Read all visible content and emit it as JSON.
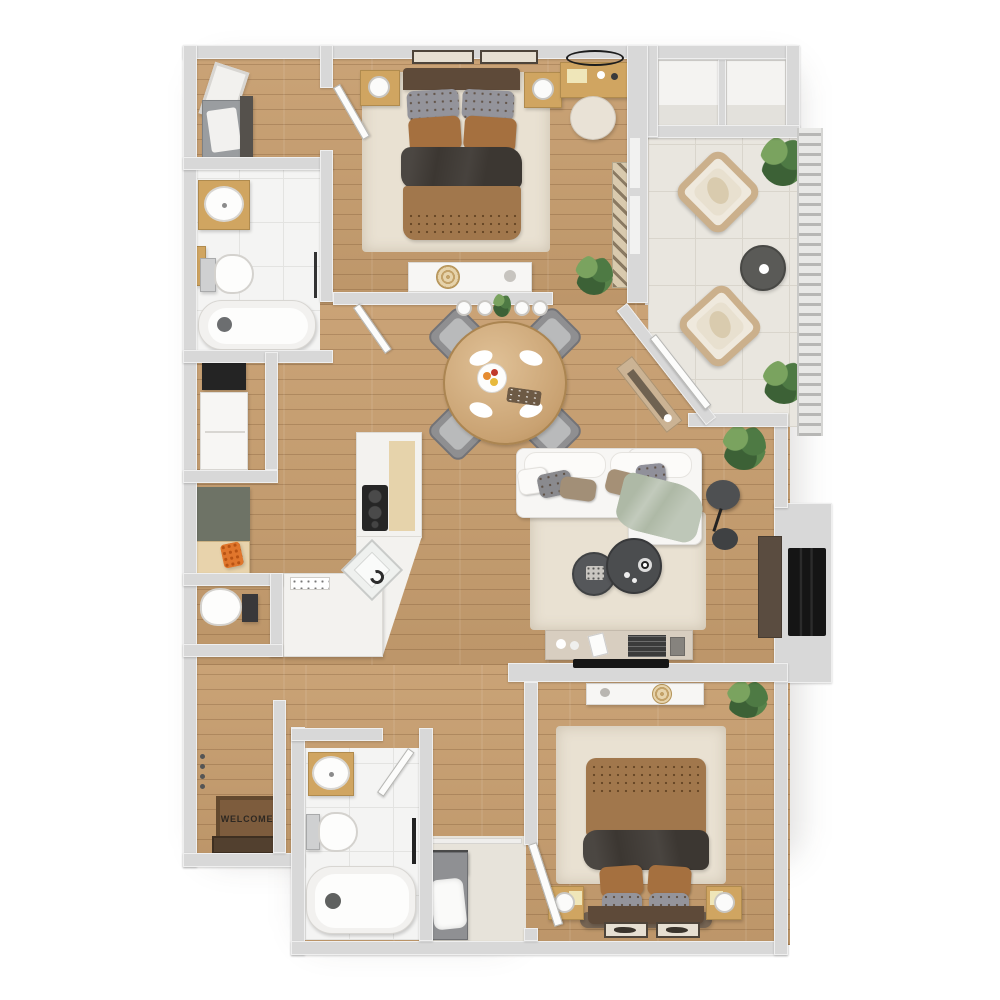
{
  "labels": {
    "welcome_mat": "WELCOME"
  },
  "palette": {
    "wall": "#d8d8d8",
    "wood": "#c79e6f",
    "tile": "#f4f4f3",
    "grout": "#e3e3e1",
    "balcony_tile": "#e9e6df",
    "balcony_grout": "#d9d5cc",
    "rug": "#e9e1d2",
    "duvet": "#a1774c",
    "blanket": "#3c3732",
    "pillow_gray": "#94949b",
    "pillow_brown": "#a5703f",
    "headboard": "#5e4a39",
    "oak": "#d0a561",
    "furniture_white": "#f7f6f4",
    "sage": "#aeb9a6",
    "coffee_table": "#4b4d4f",
    "counter": "#f3f2ef",
    "olive": "#6e7366",
    "firebox": "#151515",
    "hearth": "#5a4c40",
    "mat": "#7d5c3d",
    "steel": "#9a9da0"
  },
  "rooms": [
    {
      "name": "walk-in-closet",
      "items": [
        "ironing-board",
        "laundry-hamper"
      ]
    },
    {
      "name": "bathroom-1",
      "items": [
        "vanity-sink",
        "toilet",
        "bathtub",
        "towel-bar"
      ]
    },
    {
      "name": "bedroom-1",
      "items": [
        "double-bed",
        "nightstand-left",
        "nightstand-right",
        "wall-art",
        "vanity-desk",
        "round-mirror",
        "stool",
        "wardrobe-rack",
        "dresser",
        "plant",
        "area-rug"
      ]
    },
    {
      "name": "dining-area",
      "items": [
        "round-dining-table",
        "dining-chairs-x4",
        "fruit-bowl",
        "pendant-lights",
        "diagonal-sideboard"
      ]
    },
    {
      "name": "kitchen",
      "items": [
        "coffee-machine",
        "refrigerator",
        "olive-cabinet",
        "pantry-cabinet",
        "cooktop",
        "sink",
        "angled-counter"
      ]
    },
    {
      "name": "powder-room",
      "items": [
        "toilet"
      ]
    },
    {
      "name": "entry",
      "items": [
        "welcome-mat",
        "entry-door",
        "coat-hooks"
      ]
    },
    {
      "name": "living-room",
      "items": [
        "sofa",
        "sage-throw",
        "coffee-tables-x2",
        "area-rug",
        "arc-floor-lamp",
        "tv-console",
        "tv",
        "fireplace",
        "plant"
      ]
    },
    {
      "name": "balcony",
      "items": [
        "storage-cabinets-x2",
        "wicker-chairs-x2",
        "round-side-table",
        "railing",
        "plants",
        "sliding-door"
      ]
    },
    {
      "name": "bathroom-2",
      "items": [
        "vanity-sink",
        "toilet",
        "bathtub",
        "towel-bar"
      ]
    },
    {
      "name": "laundry-closet",
      "items": [
        "laundry-hamper",
        "shelf-rod"
      ]
    },
    {
      "name": "bedroom-2",
      "items": [
        "double-bed",
        "nightstand-left",
        "nightstand-right",
        "dresser",
        "wall-art-x2",
        "plant",
        "area-rug"
      ]
    }
  ]
}
